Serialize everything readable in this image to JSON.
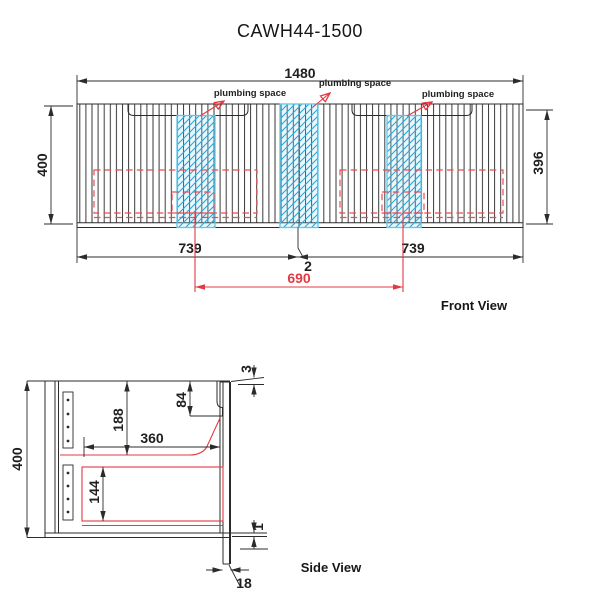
{
  "title": "CAWH44-1500",
  "colors": {
    "line": "#2b2b2b",
    "dimension_red": "#e23a42",
    "dashed_red": "#ee4a52",
    "plumbing_cyan_border": "#5ec8ec",
    "plumbing_cyan_hatch": "#2ba5d8"
  },
  "views": {
    "front": {
      "name": "Front View",
      "dim_total_width": "1480",
      "dim_height_left": "400",
      "dim_height_right": "396",
      "dim_half_left": "739",
      "dim_half_right": "739",
      "dim_door_gap": "2",
      "dim_plumbing_centers": "690",
      "plumbing_label_left": "plumbing space",
      "plumbing_label_center": "plumbing space",
      "plumbing_label_right": "plumbing space"
    },
    "side": {
      "name": "Side View",
      "dim_height": "400",
      "dim_top_gap": "3",
      "dim_recess_height": "84",
      "dim_upper_cavity": "188",
      "dim_internal_depth": "360",
      "dim_lower_cavity": "144",
      "dim_bottom_gap": "1",
      "dim_door_thickness": "18"
    }
  }
}
